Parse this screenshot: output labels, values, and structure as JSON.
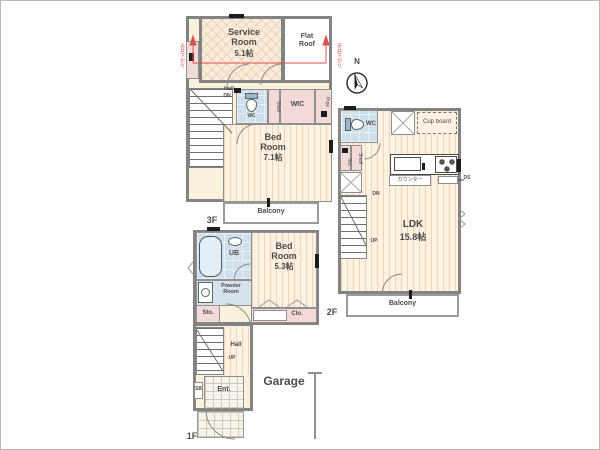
{
  "colors": {
    "wall": "#838383",
    "accent_red": "#d9534f",
    "floor_peach": "#fdf1e2",
    "room_blue": "#cfe0ec",
    "room_pink": "#f4d9d9"
  },
  "f3": {
    "floor_label": "3F",
    "service_room_name": "Service\nRoom",
    "service_room_size": "5.1帖",
    "flat_roof": "Flat\nRoof",
    "hall": "Hall",
    "dn": "DN",
    "wc": "WC",
    "shelf": "Shelf",
    "wic": "WIC",
    "pipe": "Pipe",
    "bedroom_name": "Bed\nRoom",
    "bedroom_size": "7.1帖",
    "balcony": "Balcony",
    "ceiling_note": "天井下がり"
  },
  "f2": {
    "floor_label": "2F",
    "north": "N",
    "wc": "WC",
    "cupboard": "Cup board",
    "sto": "Sto.",
    "shelf": "Shelf",
    "counter": "カウンター",
    "ds": "DS",
    "dn": "DN",
    "up": "UP",
    "ldk_name": "LDK",
    "ldk_size": "15.8帖",
    "balcony": "Balcony"
  },
  "f1": {
    "floor_label": "1F",
    "ub": "UB",
    "powder_room": "Powder\nRoom",
    "bedroom_name": "Bed\nRoom",
    "bedroom_size": "5.3帖",
    "closet": "Clo.",
    "storage": "Sto.",
    "shoe_box": "SB",
    "hall": "Hall",
    "up": "UP",
    "entrance": "Ent.",
    "garage": "Garage"
  }
}
